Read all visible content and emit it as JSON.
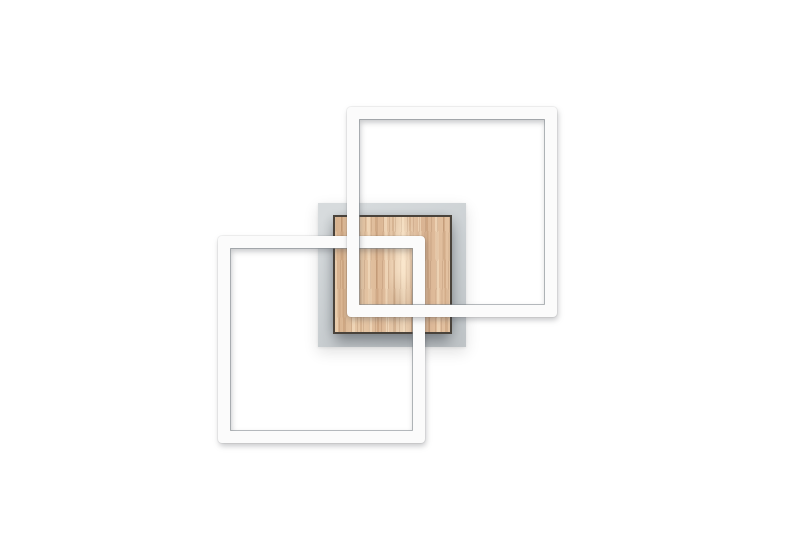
{
  "scene": {
    "type": "product-photo",
    "alt_text": "Modern LED wall light: two interlocking white square light frames mounted over a square light-wood panel on a grey square backplate, on a plain white background",
    "background_color": "#ffffff",
    "colors": {
      "background": "#ffffff",
      "frame_face": "#fbfbfb",
      "frame_edge": "#8d959a",
      "plate_light": "#d7dbdd",
      "plate_mid": "#cbd0d3",
      "plate_dark": "#bfc4c7",
      "wood_border": "#4a433b",
      "wood_light": "#efd7ba",
      "wood_mid": "#dfbd9b",
      "wood_dark": "#c79e7c"
    },
    "elements": [
      {
        "name": "mounting-plate",
        "shape": "square",
        "finish": "brushed grey metal"
      },
      {
        "name": "wood-panel",
        "shape": "square",
        "finish": "light ash wood, vertical grain, dark edge"
      },
      {
        "name": "led-frame-lower-left",
        "shape": "square frame",
        "color": "#fbfbfb",
        "layer": "behind"
      },
      {
        "name": "led-frame-upper-right",
        "shape": "square frame",
        "color": "#fbfbfb",
        "layer": "front"
      }
    ]
  }
}
